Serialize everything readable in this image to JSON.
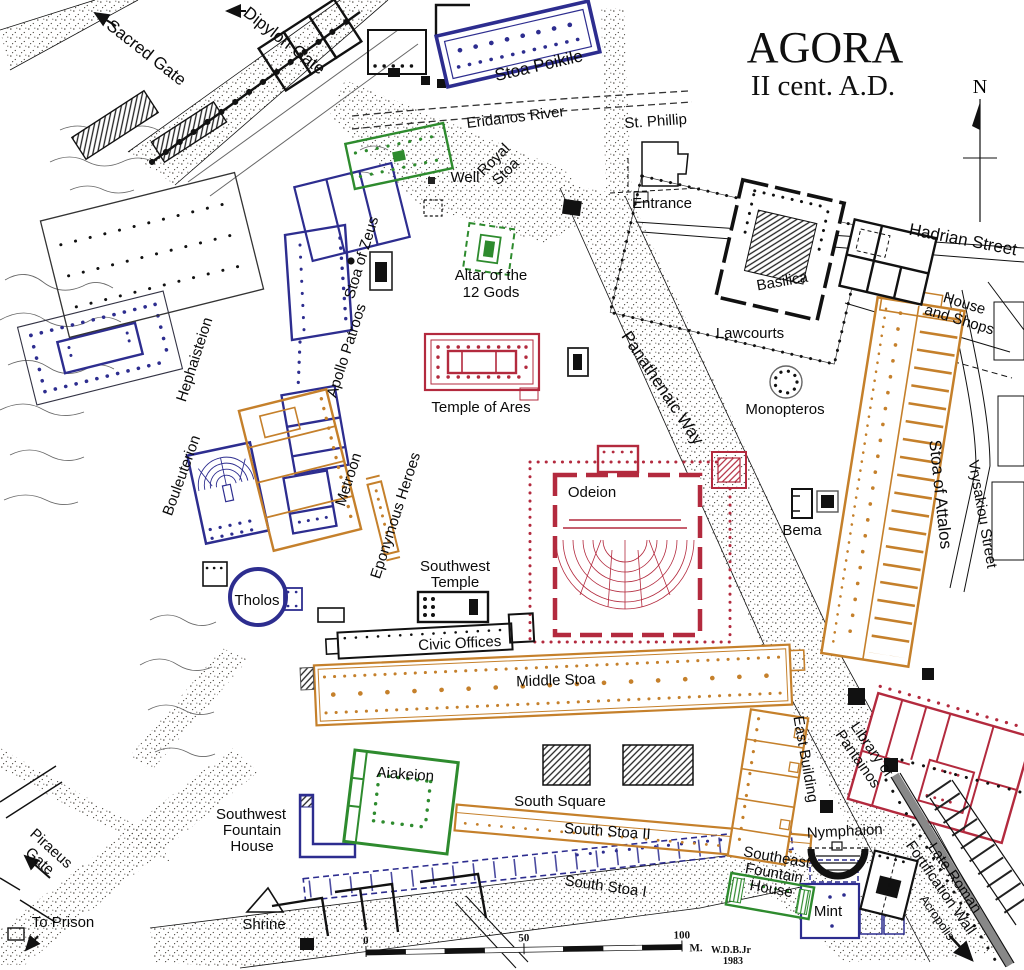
{
  "title": {
    "main": "AGORA",
    "sub": "II cent. A.D."
  },
  "compass": {
    "label": "N"
  },
  "colors": {
    "blue_buildings": "#2d2d8f",
    "green_buildings": "#2e8b2e",
    "orange_buildings": "#c5802b",
    "red_buildings": "#b32a3e",
    "black_walls": "#111111",
    "road_stipple": "#4a463f"
  },
  "scale_bar": {
    "tick_0": "0",
    "tick_50": "50",
    "tick_100": "100",
    "unit": "M.",
    "credit": "W.D.B.Jr",
    "credit_year": "1983"
  },
  "labels": {
    "sacred_gate": "Sacred Gate",
    "dipylon_gate": "Dipylon Gate",
    "stoa_poikile": "Stoa Poikile",
    "eridanos_river": "Eridanos River",
    "st_phillip": "St. Phillip",
    "well": "Well",
    "entrance": "Entrance",
    "hadrian_street": "Hadrian Street",
    "royal_stoa_1": "Royal",
    "royal_stoa_2": "Stoa",
    "stoa_of_zeus": "Stoa of Zeus",
    "basilica": "Basilica",
    "hephaisteion": "Hephaisteion",
    "apollo_patroos": "Apollo Patroos",
    "house_shops_1": "House",
    "house_shops_2": "and Shops",
    "lawcourts": "Lawcourts",
    "monopteros": "Monopteros",
    "stoa_of_attalos": "Stoa of Attalos",
    "vrysakiou_street": "Vrysakiou Street",
    "altar_1": "Altar of the",
    "altar_2": "12 Gods",
    "temple_of_ares": "Temple of Ares",
    "panathenaic_way": "Panathenaic Way",
    "odeion": "Odeion",
    "bema": "Bema",
    "metroon": "Metroon",
    "eponymous_heroes": "Eponymous Heroes",
    "bouleuterion": "Bouleuterion",
    "sw_temple_1": "Southwest",
    "sw_temple_2": "Temple",
    "tholos": "Tholos",
    "civic_offices": "Civic Offices",
    "middle_stoa": "Middle Stoa",
    "east_building": "East Building",
    "library_1": "Library of",
    "library_2": "Pantainos",
    "aiakeion": "Aiakeion",
    "south_square": "South Square",
    "south_stoa_ii": "South Stoa II",
    "sw_fountain_1": "Southwest",
    "sw_fountain_2": "Fountain",
    "sw_fountain_3": "House",
    "nymphaion": "Nymphaion",
    "se_fountain_1": "Southeast",
    "se_fountain_2": "Fountain",
    "se_fountain_3": "House",
    "piraeus_1": "Piraeus",
    "piraeus_2": "Gate",
    "to_prison": "To Prison",
    "shrine": "Shrine",
    "south_stoa_i": "South Stoa I",
    "mint": "Mint",
    "late_roman_1": "Late Roman",
    "late_roman_2": "Fortification Wall",
    "acropolis": "Acropolis"
  }
}
